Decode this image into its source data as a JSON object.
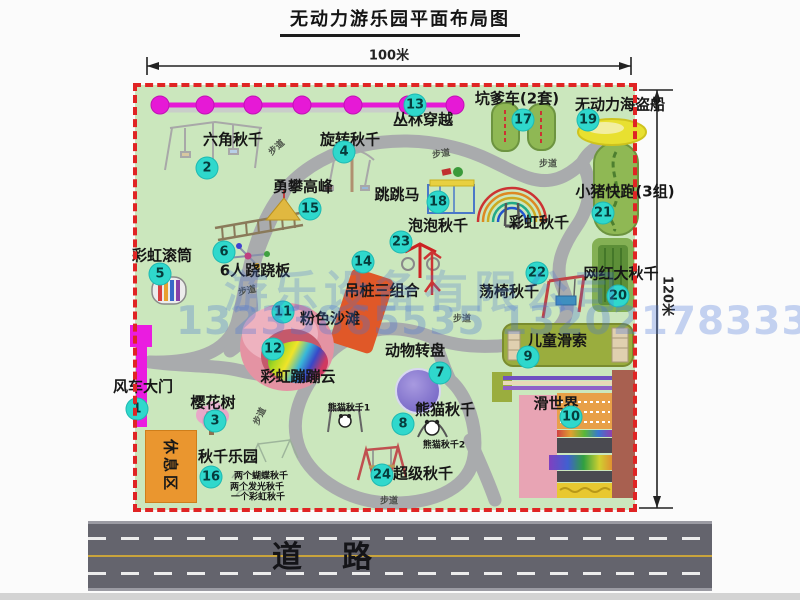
{
  "title": "无动力游乐园平面布局图",
  "dims": {
    "w": "100米",
    "h": "120米"
  },
  "road": {
    "label": "道路"
  },
  "watermark": {
    "line1": "游乐设备有限公司",
    "line2": "13233865535 13202178333"
  },
  "colors": {
    "park_green": "#cbe7bd",
    "border_red": "#e02424",
    "badge_teal": "#2fd8cc",
    "path_gray": "#a9abad",
    "road_gray": "#64646d",
    "watermark_blue": "#4673d7",
    "gate_magenta": "#ea1ce0",
    "zipline_magenta": "#e619d6"
  },
  "park": {
    "rest_area": "休息区",
    "walk_label": "步道",
    "walk_positions": [
      {
        "x": 276,
        "y": 147,
        "r": -42
      },
      {
        "x": 441,
        "y": 153,
        "r": -8
      },
      {
        "x": 548,
        "y": 163,
        "r": 0
      },
      {
        "x": 247,
        "y": 290,
        "r": -12
      },
      {
        "x": 462,
        "y": 318,
        "r": 0
      },
      {
        "x": 259,
        "y": 416,
        "r": -64
      },
      {
        "x": 389,
        "y": 500,
        "r": 0
      }
    ],
    "pois": [
      {
        "n": "1",
        "label": "风车大门",
        "bx": 137,
        "by": 409,
        "lx": 143,
        "ly": 387
      },
      {
        "n": "2",
        "label": "六角秋千",
        "bx": 207,
        "by": 168,
        "lx": 233,
        "ly": 140
      },
      {
        "n": "3",
        "label": "樱花树",
        "bx": 215,
        "by": 421,
        "lx": 213,
        "ly": 403
      },
      {
        "n": "4",
        "label": "旋转秋千",
        "bx": 344,
        "by": 152,
        "lx": 350,
        "ly": 140
      },
      {
        "n": "5",
        "label": "彩虹滚筒",
        "bx": 160,
        "by": 274,
        "lx": 162,
        "ly": 256
      },
      {
        "n": "6",
        "label": "6人跷跷板",
        "bx": 224,
        "by": 252,
        "lx": 255,
        "ly": 271
      },
      {
        "n": "7",
        "label": "动物转盘",
        "bx": 440,
        "by": 373,
        "lx": 415,
        "ly": 351
      },
      {
        "n": "8",
        "label": "熊猫秋千",
        "bx": 403,
        "by": 424,
        "lx": 445,
        "ly": 410
      },
      {
        "n": "9",
        "label": "儿童滑索",
        "bx": 528,
        "by": 357,
        "lx": 557,
        "ly": 341
      },
      {
        "n": "10",
        "label": "滑世界",
        "bx": 571,
        "by": 417,
        "lx": 556,
        "ly": 404
      },
      {
        "n": "11",
        "label": "粉色沙滩",
        "bx": 283,
        "by": 312,
        "lx": 330,
        "ly": 319
      },
      {
        "n": "12",
        "label": "彩虹蹦蹦云",
        "bx": 273,
        "by": 349,
        "lx": 298,
        "ly": 377
      },
      {
        "n": "13",
        "label": "丛林穿越",
        "bx": 415,
        "by": 105,
        "lx": 423,
        "ly": 120
      },
      {
        "n": "14",
        "label": "吊桩三组合",
        "bx": 363,
        "by": 262,
        "lx": 382,
        "ly": 291
      },
      {
        "n": "15",
        "label": "勇攀高峰",
        "bx": 310,
        "by": 209,
        "lx": 303,
        "ly": 187
      },
      {
        "n": "16",
        "label": "秋千乐园",
        "bx": 211,
        "by": 477,
        "lx": 228,
        "ly": 457
      },
      {
        "n": "17",
        "label": "坑爹车(2套)",
        "bx": 523,
        "by": 120,
        "lx": 517,
        "ly": 99
      },
      {
        "n": "18",
        "label": "跳跳马",
        "bx": 438,
        "by": 202,
        "lx": 397,
        "ly": 195
      },
      {
        "n": "19",
        "label": "无动力海盗船",
        "bx": 588,
        "by": 120,
        "lx": 620,
        "ly": 105
      },
      {
        "n": "20",
        "label": "网红大秋千",
        "bx": 618,
        "by": 296,
        "lx": 621,
        "ly": 274
      },
      {
        "n": "21",
        "label": "小猪快跑(3组)",
        "bx": 603,
        "by": 213,
        "lx": 625,
        "ly": 192
      },
      {
        "n": "22",
        "label": "荡椅秋千",
        "bx": 537,
        "by": 273,
        "lx": 509,
        "ly": 292
      },
      {
        "n": "23",
        "label": "泡泡秋千",
        "bx": 401,
        "by": 242,
        "lx": 438,
        "ly": 226
      },
      {
        "n": "24",
        "label": "超级秋千",
        "bx": 382,
        "by": 475,
        "lx": 423,
        "ly": 474
      }
    ],
    "labels_extra": [
      {
        "text": "彩虹秋千",
        "x": 539,
        "y": 223,
        "size": "main"
      },
      {
        "text": "熊猫秋千1",
        "x": 349,
        "y": 409,
        "size": "small"
      },
      {
        "text": "熊猫秋千2",
        "x": 444,
        "y": 446,
        "size": "small"
      },
      {
        "text": "两个蝴蝶秋千",
        "x": 261,
        "y": 477,
        "size": "small"
      },
      {
        "text": "两个发光秋千",
        "x": 257,
        "y": 488,
        "size": "small"
      },
      {
        "text": "一个彩虹秋千",
        "x": 258,
        "y": 498,
        "size": "small"
      }
    ]
  }
}
